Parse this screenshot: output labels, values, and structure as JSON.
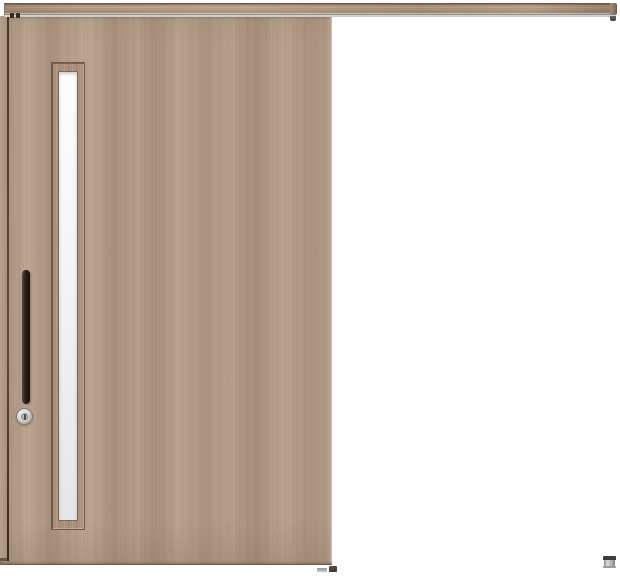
{
  "scene": {
    "description": "Product image of a closed outset single sliding wooden door with a slim vertical frosted-glass slit, wall-mounted top rail, black vertical bar handle, round thumb-turn lock, and a small floor guide at the far right",
    "background_color": "#ffffff",
    "state": "closed",
    "slide_direction": "opens to the right"
  },
  "rail": {
    "part": "top hanging rail",
    "finish": "woodgrain",
    "wood_color": "#b0967f",
    "track_color": "#c9cbcc",
    "track_shadow_color": "#8e9194",
    "end_cap_color": "#6f5a48"
  },
  "door": {
    "part": "sliding door panel",
    "finish": "woodgrain (greige walnut)",
    "base_color": "#b19a86",
    "grain_dark_color": "#9c8570",
    "grain_light_color": "#c7b19d",
    "frame_gap_color": "#3e2f24",
    "bottom_edge_color": "#6f5b4a"
  },
  "glass": {
    "part": "vertical glass slit",
    "style": "frosted",
    "top_color": "#fdfdfd",
    "bottom_color": "#e4e6e8",
    "frame_color": "#aa907b",
    "frame_line_color": "#6f5a49"
  },
  "hardware": {
    "handle": {
      "part": "vertical bar pull handle",
      "color": "#2b211b"
    },
    "lock": {
      "part": "round thumb-turn lock",
      "color": "#d6d4d1",
      "slot_color": "#4f4c47"
    },
    "bottom_guide": {
      "part": "under-door guide",
      "color": "#c9cacb"
    },
    "bottom_stopper": {
      "part": "under-door stopper",
      "color": "#3c342b"
    },
    "floor_guide": {
      "part": "floor guide post",
      "body_color": "#c0c0c0",
      "cap_color": "#3d3d3d"
    }
  }
}
